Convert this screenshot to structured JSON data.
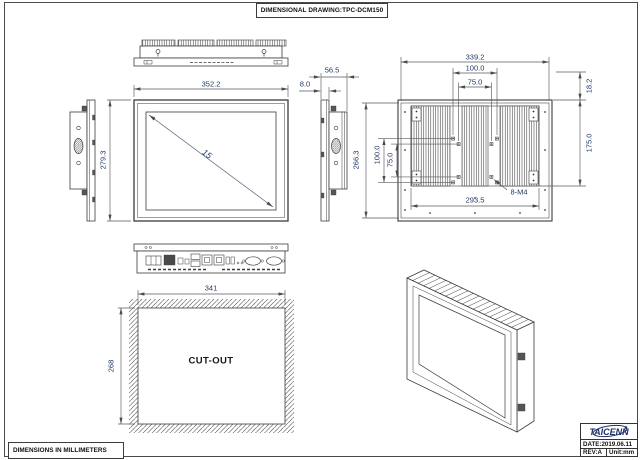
{
  "page": {
    "title": "DIMENSIONAL DRAWING:TPC-DCM150",
    "note": "DIMENSIONS IN MILLIMETERS"
  },
  "title_block": {
    "brand": "TAICENN",
    "date": "DATE:2019.06.11",
    "rev": "REV:A",
    "unit": "Unit:mm"
  },
  "front_view": {
    "width": "352.2",
    "height": "279.3",
    "diagonal": "15"
  },
  "side_view": {
    "total_depth": "56.5",
    "panel_thickness": "8.0"
  },
  "rear_view": {
    "width": "339.2",
    "vesa_width_100": "100.0",
    "vesa_width_75": "75.0",
    "top_offset": "18.2",
    "mount_span_height": "175.0",
    "height": "266.3",
    "vesa_height_100": "100.0",
    "vesa_height_75": "75.0",
    "fin_width": "293.5",
    "mount_holes": "8-M4"
  },
  "cutout_view": {
    "width": "341",
    "height": "268",
    "label": "CUT-OUT"
  },
  "colors": {
    "dimension_text": "#1f3864",
    "line": "#3c3c3c",
    "brand_navy": "#1c2f66"
  }
}
